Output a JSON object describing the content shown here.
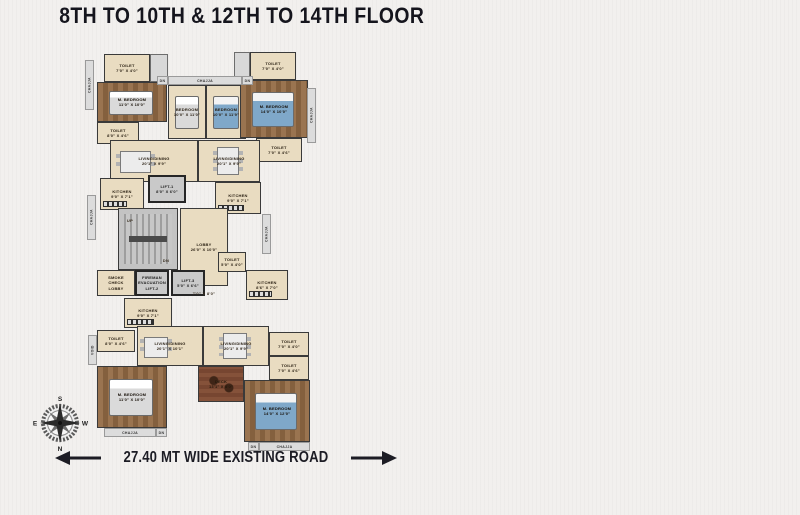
{
  "title": "8TH TO 10TH & 12TH TO 14TH FLOOR",
  "road_label": "27.40 MT WIDE EXISTING ROAD",
  "compass": {
    "top": "S",
    "right": "W",
    "bottom": "N",
    "left": "E"
  },
  "colors": {
    "background": "#f2f0ee",
    "ink": "#15151d",
    "floor_cream": "#e9dcc1",
    "floor_wood": "#8a6642",
    "wall": "#3a3a3a",
    "lift_fill": "#c9c9c9",
    "stair_fill": "#c3c3c3",
    "deck_wood": "#7d4e36",
    "bed_blue": "#7fa8c9"
  },
  "plan": {
    "rooms": [
      {
        "id": "toilet-topleft",
        "label": "TOILET\n7'0\" X 4'0\"",
        "x": 19,
        "y": 24,
        "w": 46,
        "h": 28,
        "fill": "cream"
      },
      {
        "id": "fixture-topleft",
        "label": "",
        "x": 65,
        "y": 24,
        "w": 18,
        "h": 28,
        "fill": "fixture"
      },
      {
        "id": "mbedroom-topleft",
        "label": "M. BEDROOM\n11'0\" X 10'0\"",
        "x": 12,
        "y": 52,
        "w": 70,
        "h": 40,
        "fill": "wood",
        "furniture": "bed-gray"
      },
      {
        "id": "toilet-topleft-2",
        "label": "TOILET\n8'0\" X 4'6\"",
        "x": 12,
        "y": 92,
        "w": 42,
        "h": 22,
        "fill": "cream"
      },
      {
        "id": "living-dining-topleft",
        "label": "LIVING/DINING\n20'1\" X 9'9\"",
        "x": 25,
        "y": 110,
        "w": 88,
        "h": 42,
        "fill": "cream",
        "furniture": "dining4"
      },
      {
        "id": "bedroom-left",
        "label": "BEDROOM\n10'0\" X 11'0\"",
        "x": 83,
        "y": 55,
        "w": 38,
        "h": 54,
        "fill": "cream",
        "furniture": "bed-gray"
      },
      {
        "id": "bedroom-right",
        "label": "BEDROOM\n10'0\" X 11'9\"",
        "x": 121,
        "y": 55,
        "w": 40,
        "h": 54,
        "fill": "cream",
        "furniture": "bed-blue"
      },
      {
        "id": "fixture-topright",
        "label": "",
        "x": 149,
        "y": 22,
        "w": 16,
        "h": 28,
        "fill": "fixture"
      },
      {
        "id": "toilet-topright",
        "label": "TOILET\n7'0\" X 4'0\"",
        "x": 165,
        "y": 22,
        "w": 46,
        "h": 28,
        "fill": "cream"
      },
      {
        "id": "mbedroom-topright",
        "label": "M. BEDROOM\n14'0\" X 10'0\"",
        "x": 155,
        "y": 50,
        "w": 68,
        "h": 58,
        "fill": "wood",
        "furniture": "bed-blue"
      },
      {
        "id": "toilet-topright-2",
        "label": "TOILET\n7'0\" X 4'6\"",
        "x": 171,
        "y": 108,
        "w": 46,
        "h": 24,
        "fill": "cream"
      },
      {
        "id": "living-dining-topright",
        "label": "LIVING/DINING\n20'1\" X 9'9\"",
        "x": 113,
        "y": 110,
        "w": 62,
        "h": 42,
        "fill": "cream",
        "furniture": "dining6"
      },
      {
        "id": "kitchen-topright",
        "label": "KITCHEN\n9'0\" X 7'1\"",
        "x": 130,
        "y": 152,
        "w": 46,
        "h": 32,
        "fill": "cream",
        "furniture": "counter"
      },
      {
        "id": "kitchen-topleft",
        "label": "KITCHEN\n9'0\" X 7'1\"",
        "x": 15,
        "y": 148,
        "w": 44,
        "h": 32,
        "fill": "cream",
        "furniture": "counter"
      },
      {
        "id": "lift-1",
        "label": "LIFT-1\n8'0\" X 6'0\"",
        "x": 63,
        "y": 145,
        "w": 38,
        "h": 28,
        "fill": "lift"
      },
      {
        "id": "staircase",
        "label": "",
        "x": 33,
        "y": 178,
        "w": 60,
        "h": 62,
        "fill": "stair",
        "furniture": "stairs-f"
      },
      {
        "id": "lobby",
        "label": "LOBBY\n26'0\" X 10'0\"",
        "x": 95,
        "y": 178,
        "w": 48,
        "h": 78,
        "fill": "cream"
      },
      {
        "id": "smoke-check-lobby",
        "label": "SMOKE\nCHECK\nLOBBY",
        "x": 12,
        "y": 240,
        "w": 38,
        "h": 26,
        "fill": "cream"
      },
      {
        "id": "fireman-evacuation-lift-2",
        "label": "FIREMAN\nEVACUATION\nLIFT-2",
        "x": 50,
        "y": 240,
        "w": 34,
        "h": 26,
        "fill": "lift"
      },
      {
        "id": "lift-3",
        "label": "LIFT-3\n5'0\" X 6'6\"",
        "x": 86,
        "y": 240,
        "w": 34,
        "h": 26,
        "fill": "lift"
      },
      {
        "id": "toilet-core",
        "label": "TOILET\n5'0\" X 4'0\"",
        "x": 133,
        "y": 222,
        "w": 28,
        "h": 20,
        "fill": "cream"
      },
      {
        "id": "kitchen-bottomright",
        "label": "KITCHEN\n8'6\" X 7'0\"",
        "x": 161,
        "y": 240,
        "w": 42,
        "h": 30,
        "fill": "cream",
        "furniture": "counter"
      },
      {
        "id": "kitchen-bottomleft",
        "label": "KITCHEN\n9'0\" X 7'1\"",
        "x": 39,
        "y": 268,
        "w": 48,
        "h": 30,
        "fill": "cream",
        "furniture": "counter"
      },
      {
        "id": "toilet-bottomleft",
        "label": "TOILET\n8'0\" X 4'6\"",
        "x": 12,
        "y": 300,
        "w": 38,
        "h": 22,
        "fill": "cream"
      },
      {
        "id": "living-dining-bottomleft",
        "label": "LIVING/DINING\n20'1\" X 10'1\"",
        "x": 52,
        "y": 296,
        "w": 66,
        "h": 40,
        "fill": "cream",
        "furniture": "dining4"
      },
      {
        "id": "living-dining-bottomright",
        "label": "LIVING/DINING\n20'1\" X 9'9\"",
        "x": 118,
        "y": 296,
        "w": 66,
        "h": 40,
        "fill": "cream",
        "furniture": "dining6"
      },
      {
        "id": "mbedroom-bottomleft",
        "label": "M. BEDROOM\n11'0\" X 10'0\"",
        "x": 12,
        "y": 336,
        "w": 70,
        "h": 62,
        "fill": "wood",
        "furniture": "bed-gray"
      },
      {
        "id": "deck",
        "label": "DECK\n13'1\" X 8'0\"",
        "x": 113,
        "y": 336,
        "w": 46,
        "h": 36,
        "fill": "deck",
        "furniture": "deck-chairs"
      },
      {
        "id": "toilet-bottomright",
        "label": "TOILET\n7'0\" X 4'0\"",
        "x": 184,
        "y": 302,
        "w": 40,
        "h": 24,
        "fill": "cream"
      },
      {
        "id": "toilet-bottomright-2",
        "label": "TOILET\n7'0\" X 4'6\"",
        "x": 184,
        "y": 326,
        "w": 40,
        "h": 24,
        "fill": "cream"
      },
      {
        "id": "mbedroom-bottomright",
        "label": "M. BEDROOM\n14'0\" X 12'0\"",
        "x": 159,
        "y": 350,
        "w": 66,
        "h": 62,
        "fill": "wood",
        "furniture": "bed-blue"
      }
    ],
    "strips": [
      {
        "id": "chajja-left-top",
        "label": "CHAJJA",
        "x": 0,
        "y": 30,
        "w": 9,
        "h": 50,
        "vert": true
      },
      {
        "id": "chajja-left-mid",
        "label": "CHAJJA",
        "x": 2,
        "y": 165,
        "w": 9,
        "h": 45,
        "vert": true
      },
      {
        "id": "void-left",
        "label": "VOID",
        "x": 3,
        "y": 305,
        "w": 9,
        "h": 30,
        "vert": true
      },
      {
        "id": "chajja-right-top",
        "label": "CHAJJA",
        "x": 222,
        "y": 58,
        "w": 9,
        "h": 55,
        "vert": true
      },
      {
        "id": "chajja-right-mid",
        "label": "CHAJJA",
        "x": 177,
        "y": 184,
        "w": 9,
        "h": 40,
        "vert": true
      },
      {
        "id": "void-right",
        "label": "VOID",
        "x": 215,
        "y": 414,
        "w": 9,
        "h": 0,
        "vert": true,
        "hidden": true
      },
      {
        "id": "chajja-top",
        "label": "CHAJJA",
        "x": 83,
        "y": 46,
        "w": 74,
        "h": 9,
        "vert": false
      },
      {
        "id": "dn-top-left",
        "label": "DN",
        "x": 72,
        "y": 46,
        "w": 11,
        "h": 9,
        "vert": false
      },
      {
        "id": "dn-top-right",
        "label": "DN",
        "x": 157,
        "y": 46,
        "w": 11,
        "h": 9,
        "vert": false
      },
      {
        "id": "chajja-bottomleft",
        "label": "CHAJJA",
        "x": 19,
        "y": 398,
        "w": 52,
        "h": 9,
        "vert": false
      },
      {
        "id": "dn-bottomleft",
        "label": "DN",
        "x": 71,
        "y": 398,
        "w": 11,
        "h": 9,
        "vert": false
      },
      {
        "id": "dn-bottomright",
        "label": "DN",
        "x": 163,
        "y": 412,
        "w": 11,
        "h": 9,
        "vert": false
      },
      {
        "id": "chajja-bottomright",
        "label": "CHAJJA",
        "x": 174,
        "y": 412,
        "w": 51,
        "h": 9,
        "vert": false
      },
      {
        "id": "stairs-up",
        "label": "UP",
        "x": 38,
        "y": 186,
        "w": 14,
        "h": 8,
        "vert": false,
        "bare": true
      },
      {
        "id": "stairs-dn",
        "label": "DN",
        "x": 74,
        "y": 226,
        "w": 14,
        "h": 8,
        "vert": false,
        "bare": true
      },
      {
        "id": "passage-dim",
        "label": "7'0\" X 8'0\"",
        "x": 95,
        "y": 258,
        "w": 48,
        "h": 10,
        "vert": false,
        "bare": true
      }
    ]
  }
}
